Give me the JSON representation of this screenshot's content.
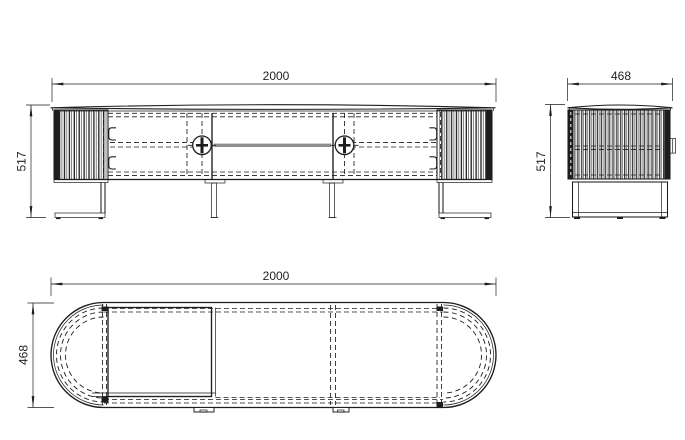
{
  "colors": {
    "line": "#1d1d1d",
    "background": "#ffffff",
    "shelf_bar": "#8f8f8f"
  },
  "views": {
    "front": {
      "width_dim": "2000",
      "height_dim": "517"
    },
    "side": {
      "width_dim": "468",
      "height_dim": "517"
    },
    "top": {
      "width_dim": "2000",
      "depth_dim": "468"
    }
  }
}
